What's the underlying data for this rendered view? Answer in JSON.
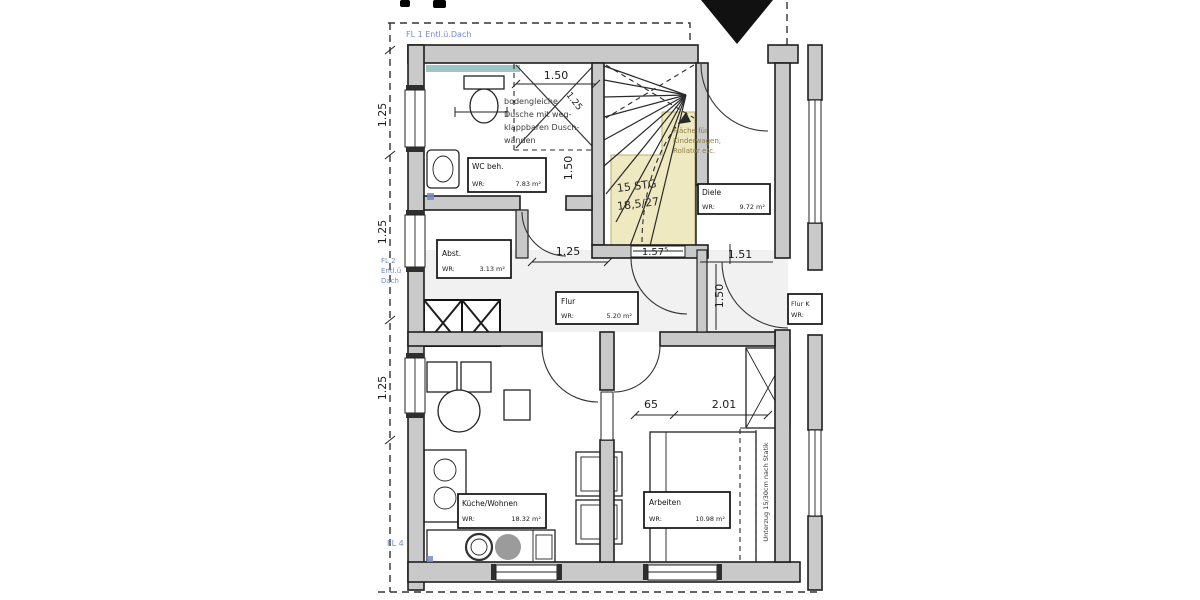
{
  "plan": {
    "blue_marks": {
      "fl1": "FL 1 Entl.ü.Dach",
      "fl2_l1": "FL 2",
      "fl2_l2": "Entl.ü",
      "fl2_l3": "Dach",
      "fl4": "FL 4"
    },
    "rooms": {
      "wc": {
        "name": "WC beh.",
        "wr": "WR:",
        "area": "7.83 m²"
      },
      "diele": {
        "name": "Diele",
        "wr": "WR:",
        "area": "9.72 m²"
      },
      "abst": {
        "name": "Abst.",
        "wr": "WR:",
        "area": "3.13 m²"
      },
      "flur": {
        "name": "Flur",
        "wr": "WR:",
        "area": "5.20 m²"
      },
      "kueche": {
        "name": "Küche/Wohnen",
        "wr": "WR:",
        "area": "18.32 m²"
      },
      "arbeiten": {
        "name": "Arbeiten",
        "wr": "WR:",
        "area": "10.98 m²"
      },
      "flur_k": {
        "name": "Flur K",
        "wr": "WR:"
      }
    },
    "stairs": {
      "l1": "15 STG",
      "l2": "18,5/27"
    },
    "notes": {
      "shower_l1": "bodengleiche",
      "shower_l2": "Dusche mit weg-",
      "shower_l3": "klappbaren Dusch-",
      "shower_l4": "wänden",
      "kinderwagen_l1": "Fläche für",
      "kinderwagen_l2": "Kinderwagen,",
      "kinderwagen_l3": "Rollator etc.",
      "unterzug": "Unterzug 15/30cm nach Statik"
    },
    "dims": {
      "bath_w": "1.50",
      "bath_diag": "1.25",
      "bath_h": "1.50",
      "left_a": "1.25",
      "left_b": "1.25",
      "left_c": "1.25",
      "flur_w": "1.25",
      "stair_w": "1.57⁵",
      "diele_w": "1.51",
      "diele_h": "1.50",
      "arb_a": "65",
      "arb_b": "2.01"
    },
    "colors": {
      "wall": "#c9c9c9",
      "yellow": "#efe9c1",
      "teal": "#9cc5c6",
      "blue": "#7489c8"
    }
  }
}
